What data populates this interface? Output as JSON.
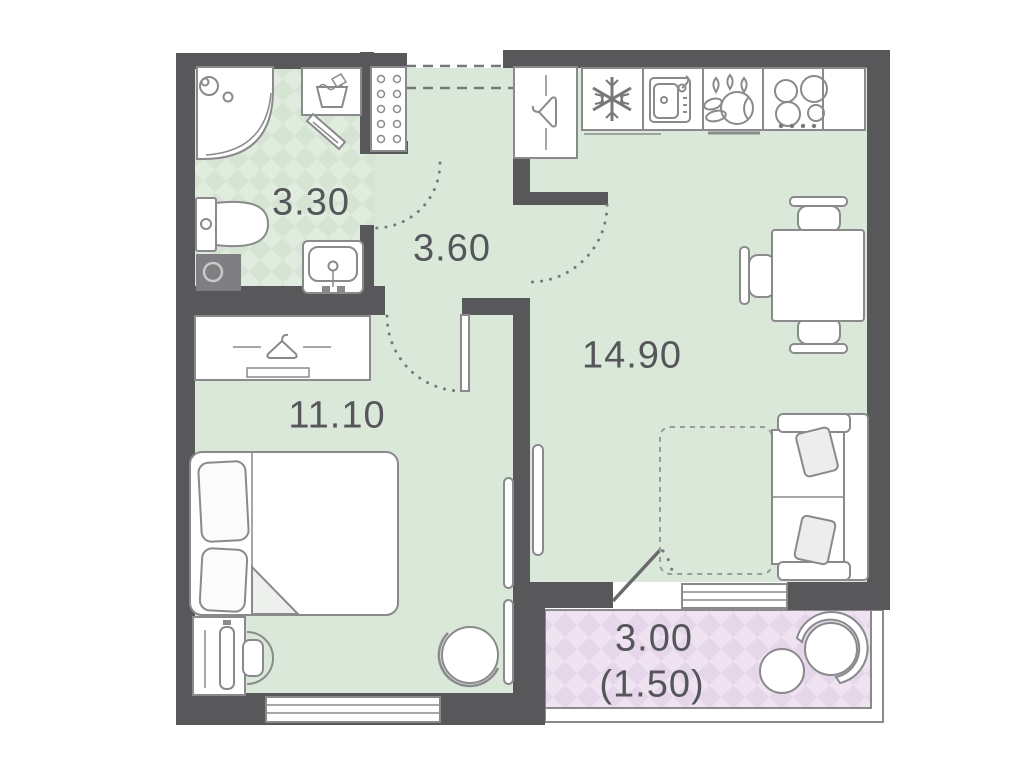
{
  "plan": {
    "type": "apartment-floor-plan",
    "rooms": {
      "bathroom": {
        "name": "bathroom",
        "area": "3.30"
      },
      "hallway": {
        "name": "hallway",
        "area": "3.60"
      },
      "kitchen_living": {
        "name": "kitchen-living-room",
        "area": "14.90"
      },
      "bedroom": {
        "name": "bedroom",
        "area": "11.10"
      },
      "balcony": {
        "name": "balcony",
        "area": "3.00",
        "area_coefficient": "(1.50)"
      }
    },
    "colors": {
      "wall": "#58585a",
      "floor": "#dae8da",
      "wet_floor_base": "#d5e4d3",
      "wet_floor_alt": "#e0ecde",
      "balcony_floor_base": "#e6d6ea",
      "balcony_floor_alt": "#efe3f2",
      "furniture_outline": "#8a8a8c",
      "label_text": "#55565a"
    },
    "fixtures": [
      "shower",
      "washing-machine",
      "towel-rail",
      "toilet",
      "vent-shaft",
      "bathroom-sink",
      "shoe-cabinet",
      "entry-closet",
      "fridge",
      "kitchen-sink",
      "dishwasher",
      "stove",
      "dining-table",
      "dining-chairs",
      "sofa",
      "sofa-bed-extension",
      "dining-window",
      "bed",
      "wardrobe",
      "desk",
      "desk-chair",
      "armchair",
      "bedroom-window",
      "balcony-table",
      "balcony-chairs",
      "entrance-door",
      "interior-doors"
    ]
  }
}
